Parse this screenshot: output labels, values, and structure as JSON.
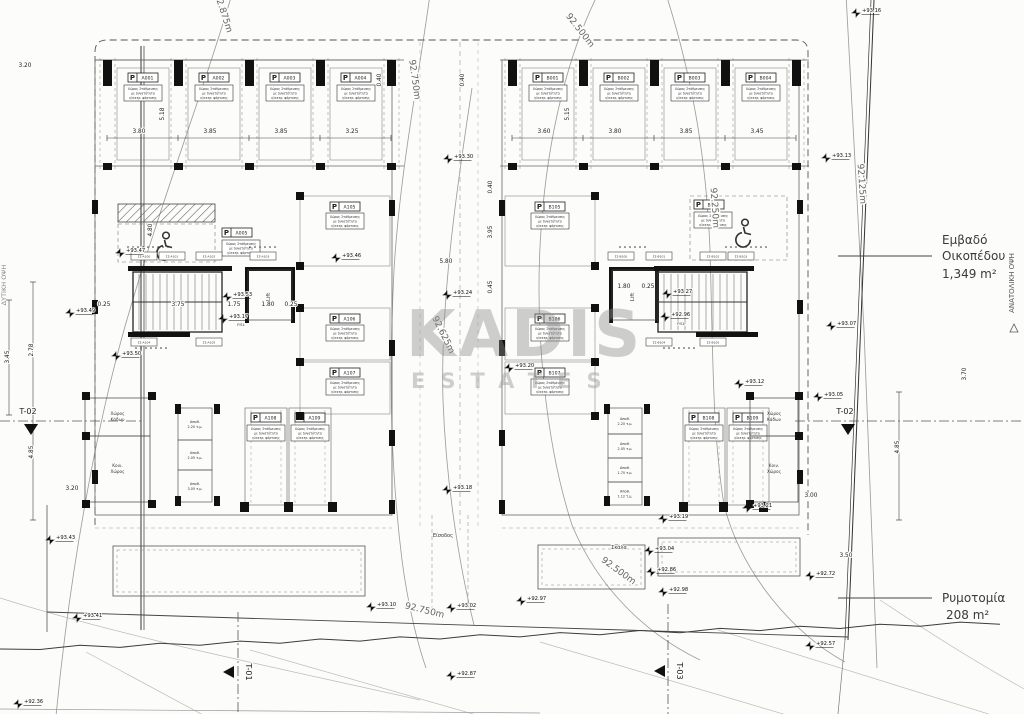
{
  "drawing": {
    "type": "architectural-site-plan",
    "watermark": {
      "l1": "KADIS",
      "l2": "ESTATES"
    }
  },
  "annotations": {
    "plot_area": {
      "label_line1": "Εμβαδό",
      "label_line2": "Οικοπέδου",
      "value": "1,349  m²"
    },
    "road_widening": {
      "label": "Ρυμοτομία",
      "value": "208  m²"
    },
    "east_elevation": "ΑΝΑΤΟΛΙΚΗ ΟΨΗ",
    "west_elevation": "ΔΥΤΙΚΗ ΟΨΗ"
  },
  "parking_note": [
    "Χώρος Στάθμευσης",
    "με δυνατότητα",
    "ηλεκτρ. φόρτισης"
  ],
  "lift_label": "Lift",
  "stalls": {
    "left_top": [
      "A001",
      "A002",
      "A003",
      "A004"
    ],
    "right_top": [
      "B001",
      "B002",
      "B003",
      "B004"
    ],
    "left_inner": [
      "A105",
      "A106",
      "A107"
    ],
    "right_inner": [
      "B105",
      "B106",
      "B107"
    ],
    "left_bottom": [
      "A108",
      "A109"
    ],
    "right_bottom": [
      "B108",
      "B109"
    ],
    "accessible_left": "A005",
    "accessible_right": "B005"
  },
  "rooms": {
    "left": [
      [
        "Χώρος",
        "Κάδων"
      ],
      [
        "Κοιν.",
        "Χώρος"
      ]
    ],
    "right": [
      [
        "Χώρος",
        "Κάδων"
      ],
      [
        "Κοιν.",
        "Χώρος"
      ]
    ]
  },
  "storage": {
    "left": [
      [
        "Αποθ.",
        "2.20 τ.μ."
      ],
      [
        "Αποθ.",
        "2.05 τ.μ."
      ],
      [
        "Αποθ.",
        "3.05 τ.μ."
      ]
    ],
    "right": [
      [
        "Αποθ.",
        "2.20 τ.μ."
      ],
      [
        "Αποθ.",
        "2.05 τ.μ."
      ],
      [
        "Αποθ.",
        "1.70 τ.μ."
      ],
      [
        "Αποθ.",
        "1.12 τ.μ."
      ]
    ]
  },
  "tag_boxes": {
    "left": [
      "ΣΣ-Α100",
      "ΣΣ-Α101",
      "ΣΣ-Α102",
      "ΣΣ-Α103",
      "ΣΣ-Α104",
      "ΣΣ-Α105"
    ],
    "right": [
      "ΣΣ-Β100",
      "ΣΣ-Β101",
      "ΣΣ-Β102",
      "ΣΣ-Β103",
      "ΣΣ-Β104",
      "ΣΣ-Β105"
    ]
  },
  "contours": [
    {
      "label": "92.875m",
      "rot": 72,
      "lx": 221,
      "ly": 14,
      "path": "M232,-6 C204,90 158,210 124,330 C96,430 70,570 56,716"
    },
    {
      "label": "92.750m",
      "rot": 82,
      "lx": 412,
      "ly": 80,
      "path": "M430,-6 C420,70 400,170 394,270 C388,390 392,480 402,560 C408,606 418,645 426,668"
    },
    {
      "label": "92.750m",
      "rot": 14,
      "lx": 424,
      "ly": 613,
      "path": null
    },
    {
      "label": "92.625m",
      "rot": 64,
      "lx": 441,
      "ly": 336,
      "path": "M472,88 C458,180 440,300 443,400 C446,480 458,560 474,625"
    },
    {
      "label": "92.500m",
      "rot": 52,
      "lx": 578,
      "ly": 32,
      "path": "M598,-6 C570,50 548,130 541,230 C534,330 546,445 572,525 C598,588 646,634 700,660"
    },
    {
      "label": "92.500m",
      "rot": 36,
      "lx": 617,
      "ly": 573,
      "path": null
    },
    {
      "label": "92.250m",
      "rot": 86,
      "lx": 712,
      "ly": 208,
      "path": "M666,-6 C690,70 706,150 710,250 C713,350 712,430 724,505 C742,575 795,635 845,662"
    },
    {
      "label": "92.125m",
      "rot": 86,
      "lx": 859,
      "ly": 184,
      "path": "M846,-6 C852,90 858,210 864,330 C869,450 873,570 877,668"
    }
  ],
  "spot_levels": [
    {
      "t": "+93.16",
      "x": 856,
      "y": 13
    },
    {
      "t": "+93.13",
      "x": 826,
      "y": 158
    },
    {
      "t": "+93.30",
      "x": 448,
      "y": 159
    },
    {
      "t": "+93.47",
      "x": 120,
      "y": 253
    },
    {
      "t": "+93.46",
      "x": 336,
      "y": 258
    },
    {
      "t": "+93.49",
      "x": 70,
      "y": 313
    },
    {
      "t": "+93.50",
      "x": 116,
      "y": 356
    },
    {
      "t": "+93.53",
      "x": 227,
      "y": 297
    },
    {
      "t": "+93.17",
      "x": 223,
      "y": 319
    },
    {
      "t": "+93.24",
      "x": 447,
      "y": 295
    },
    {
      "t": "+93.20",
      "x": 509,
      "y": 368
    },
    {
      "t": "+93.18",
      "x": 447,
      "y": 490
    },
    {
      "t": "+93.27",
      "x": 667,
      "y": 294
    },
    {
      "t": "+92.96",
      "x": 665,
      "y": 317
    },
    {
      "t": "+93.07",
      "x": 831,
      "y": 326
    },
    {
      "t": "+93.12",
      "x": 739,
      "y": 384
    },
    {
      "t": "+93.05",
      "x": 818,
      "y": 397
    },
    {
      "t": "+93.43",
      "x": 50,
      "y": 540
    },
    {
      "t": "+93.41",
      "x": 77,
      "y": 618
    },
    {
      "t": "+93.19",
      "x": 663,
      "y": 519
    },
    {
      "t": "+93.21",
      "x": 747,
      "y": 508
    },
    {
      "t": "+93.10",
      "x": 371,
      "y": 607
    },
    {
      "t": "+93.02",
      "x": 451,
      "y": 608
    },
    {
      "t": "+92.97",
      "x": 521,
      "y": 601
    },
    {
      "t": "+93.04",
      "x": 649,
      "y": 551
    },
    {
      "t": "+92.86",
      "x": 651,
      "y": 572
    },
    {
      "t": "+92.98",
      "x": 663,
      "y": 592
    },
    {
      "t": "+92.72",
      "x": 810,
      "y": 576
    },
    {
      "t": "+92.57",
      "x": 810,
      "y": 646
    },
    {
      "t": "+92.87",
      "x": 451,
      "y": 676
    },
    {
      "t": "+92.36",
      "x": 18,
      "y": 704
    }
  ],
  "dims": [
    {
      "t": "3.20",
      "x": 25,
      "y": 67
    },
    {
      "t": "3.80",
      "x": 139,
      "y": 133
    },
    {
      "t": "3.85",
      "x": 210,
      "y": 133
    },
    {
      "t": "3.85",
      "x": 281,
      "y": 133
    },
    {
      "t": "3.25",
      "x": 352,
      "y": 133
    },
    {
      "t": "3.60",
      "x": 544,
      "y": 133
    },
    {
      "t": "3.80",
      "x": 615,
      "y": 133
    },
    {
      "t": "3.85",
      "x": 686,
      "y": 133
    },
    {
      "t": "3.45",
      "x": 757,
      "y": 133
    },
    {
      "t": "5.18",
      "x": 164,
      "y": 114,
      "r": -90
    },
    {
      "t": "5.15",
      "x": 569,
      "y": 114,
      "r": -90
    },
    {
      "t": "0.40",
      "x": 381,
      "y": 80,
      "r": -90
    },
    {
      "t": "0.40",
      "x": 464,
      "y": 80,
      "r": -90
    },
    {
      "t": "4.80",
      "x": 152,
      "y": 230,
      "r": -90
    },
    {
      "t": "2.78",
      "x": 33,
      "y": 350,
      "r": -90
    },
    {
      "t": "3.45",
      "x": 9,
      "y": 357,
      "r": -90
    },
    {
      "t": "4.85",
      "x": 33,
      "y": 452,
      "r": -90
    },
    {
      "t": "3.20",
      "x": 72,
      "y": 490
    },
    {
      "t": "4.85",
      "x": 899,
      "y": 447,
      "r": -90
    },
    {
      "t": "3.00",
      "x": 811,
      "y": 497
    },
    {
      "t": "3.50",
      "x": 846,
      "y": 557
    },
    {
      "t": "3.70",
      "x": 966,
      "y": 374,
      "r": -90
    },
    {
      "t": "0.40",
      "x": 492,
      "y": 187,
      "r": -90
    },
    {
      "t": "3.95",
      "x": 492,
      "y": 232,
      "r": -90
    },
    {
      "t": "0.45",
      "x": 492,
      "y": 287,
      "r": -90
    },
    {
      "t": "5.80",
      "x": 446,
      "y": 263
    },
    {
      "t": "0.25",
      "x": 104,
      "y": 306
    },
    {
      "t": "3.75",
      "x": 178,
      "y": 306
    },
    {
      "t": "1.75",
      "x": 234,
      "y": 306
    },
    {
      "t": "1.80",
      "x": 268,
      "y": 306
    },
    {
      "t": "0.25",
      "x": 291,
      "y": 306
    },
    {
      "t": "1.80",
      "x": 624,
      "y": 288
    },
    {
      "t": "0.25",
      "x": 648,
      "y": 288
    }
  ],
  "section_markers": [
    {
      "label": "T-02",
      "tx": 28,
      "ty": 414,
      "trix": 31,
      "triy": 429,
      "dir": "down",
      "x1": 0,
      "y1": 421,
      "x2": 142,
      "y2": 421,
      "rot": 0
    },
    {
      "label": "T-02",
      "tx": 845,
      "ty": 414,
      "trix": 848,
      "triy": 429,
      "dir": "down",
      "x1": 795,
      "y1": 421,
      "x2": 1024,
      "y2": 421,
      "rot": 0
    },
    {
      "label": "T-01",
      "tx": 246,
      "ty": 672,
      "trix": 229,
      "triy": 672,
      "dir": "left",
      "x1": 238,
      "y1": 612,
      "x2": 238,
      "y2": 714,
      "rot": 90
    },
    {
      "label": "T-03",
      "tx": 677,
      "ty": 671,
      "trix": 660,
      "triy": 671,
      "dir": "left",
      "x1": 668,
      "y1": 604,
      "x2": 668,
      "y2": 714,
      "rot": 90
    }
  ],
  "misc_labels": [
    {
      "t": "Είσοδος",
      "x": 443,
      "y": 537,
      "s": 5
    },
    {
      "t": "Σκάλα",
      "x": 619,
      "y": 549,
      "s": 5
    },
    {
      "t": "P.SL",
      "x": 241,
      "y": 326,
      "s": 3.8
    },
    {
      "t": "P.SL",
      "x": 681,
      "y": 325,
      "s": 3.8
    }
  ]
}
